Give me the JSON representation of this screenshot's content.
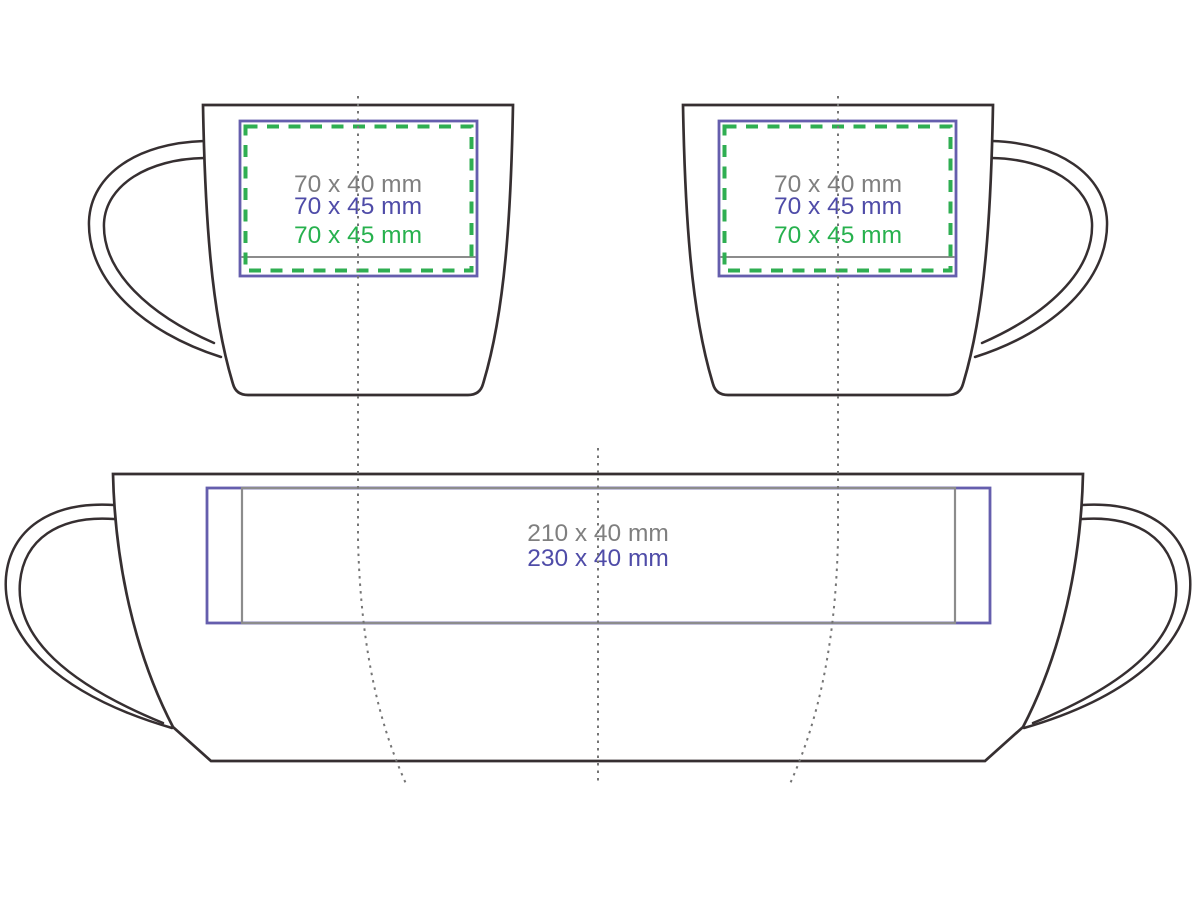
{
  "colors": {
    "outline": "#362f31",
    "blue": "#655ead",
    "blue_text": "#4f4ca8",
    "green": "#2fae52",
    "green_text": "#27b14e",
    "gray_line": "#8c8c8c",
    "gray_text": "#7f7f7f",
    "dotted": "#757575"
  },
  "front_left": {
    "size_gray": "70 x 40 mm",
    "size_blue": "70 x 45 mm",
    "size_green": "70 x 45 mm"
  },
  "front_right": {
    "size_gray": "70 x 40 mm",
    "size_blue": "70 x 45 mm",
    "size_green": "70 x 45 mm"
  },
  "wrap": {
    "size_gray": "210 x 40 mm",
    "size_blue": "230 x 40 mm"
  }
}
